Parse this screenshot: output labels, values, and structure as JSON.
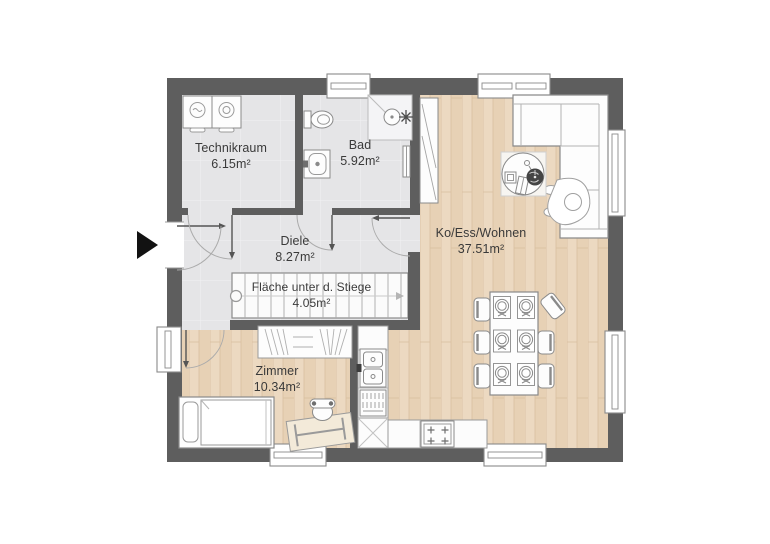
{
  "plan_title": "Erdgeschoss Grundriss",
  "rooms": {
    "technikraum": {
      "name": "Technikraum",
      "area": "6.15m²"
    },
    "bad": {
      "name": "Bad",
      "area": "5.92m²"
    },
    "diele": {
      "name": "Diele",
      "area": "8.27m²"
    },
    "stiege": {
      "name": "Fläche unter d. Stiege",
      "area": "4.05m²"
    },
    "wohnen": {
      "name": "Ko/Ess/Wohnen",
      "area": "37.51m²"
    },
    "zimmer": {
      "name": "Zimmer",
      "area": "10.34m²"
    }
  },
  "icons": [
    "entrance-arrow-icon",
    "washing-machine-icon",
    "dryer-icon",
    "toilet-icon",
    "washbasin-icon",
    "shower-icon",
    "towel-radiator-icon",
    "tall-cabinet-icon",
    "sofa-icon",
    "person-icon",
    "coffee-table-icon",
    "plant-icon",
    "dining-table-icon",
    "chair-icon",
    "place-setting-icon",
    "kitchen-sink-icon",
    "dishwasher-icon",
    "corner-cabinet-icon",
    "cooktop-icon",
    "wardrobe-icon",
    "bed-icon",
    "desk-icon",
    "desk-chair-icon",
    "stairs-icon",
    "window-icon",
    "door-swing-icon"
  ],
  "colors": {
    "wall": "#5e5e5e",
    "hard_floor": "#e5e5e7",
    "wood_floor": "#ead7bf",
    "furniture_fill": "#fdfdfd",
    "furniture_line": "#8a8a8a",
    "text": "#3a3a3a",
    "entrance_arrow": "#121212",
    "background": "#ffffff"
  }
}
